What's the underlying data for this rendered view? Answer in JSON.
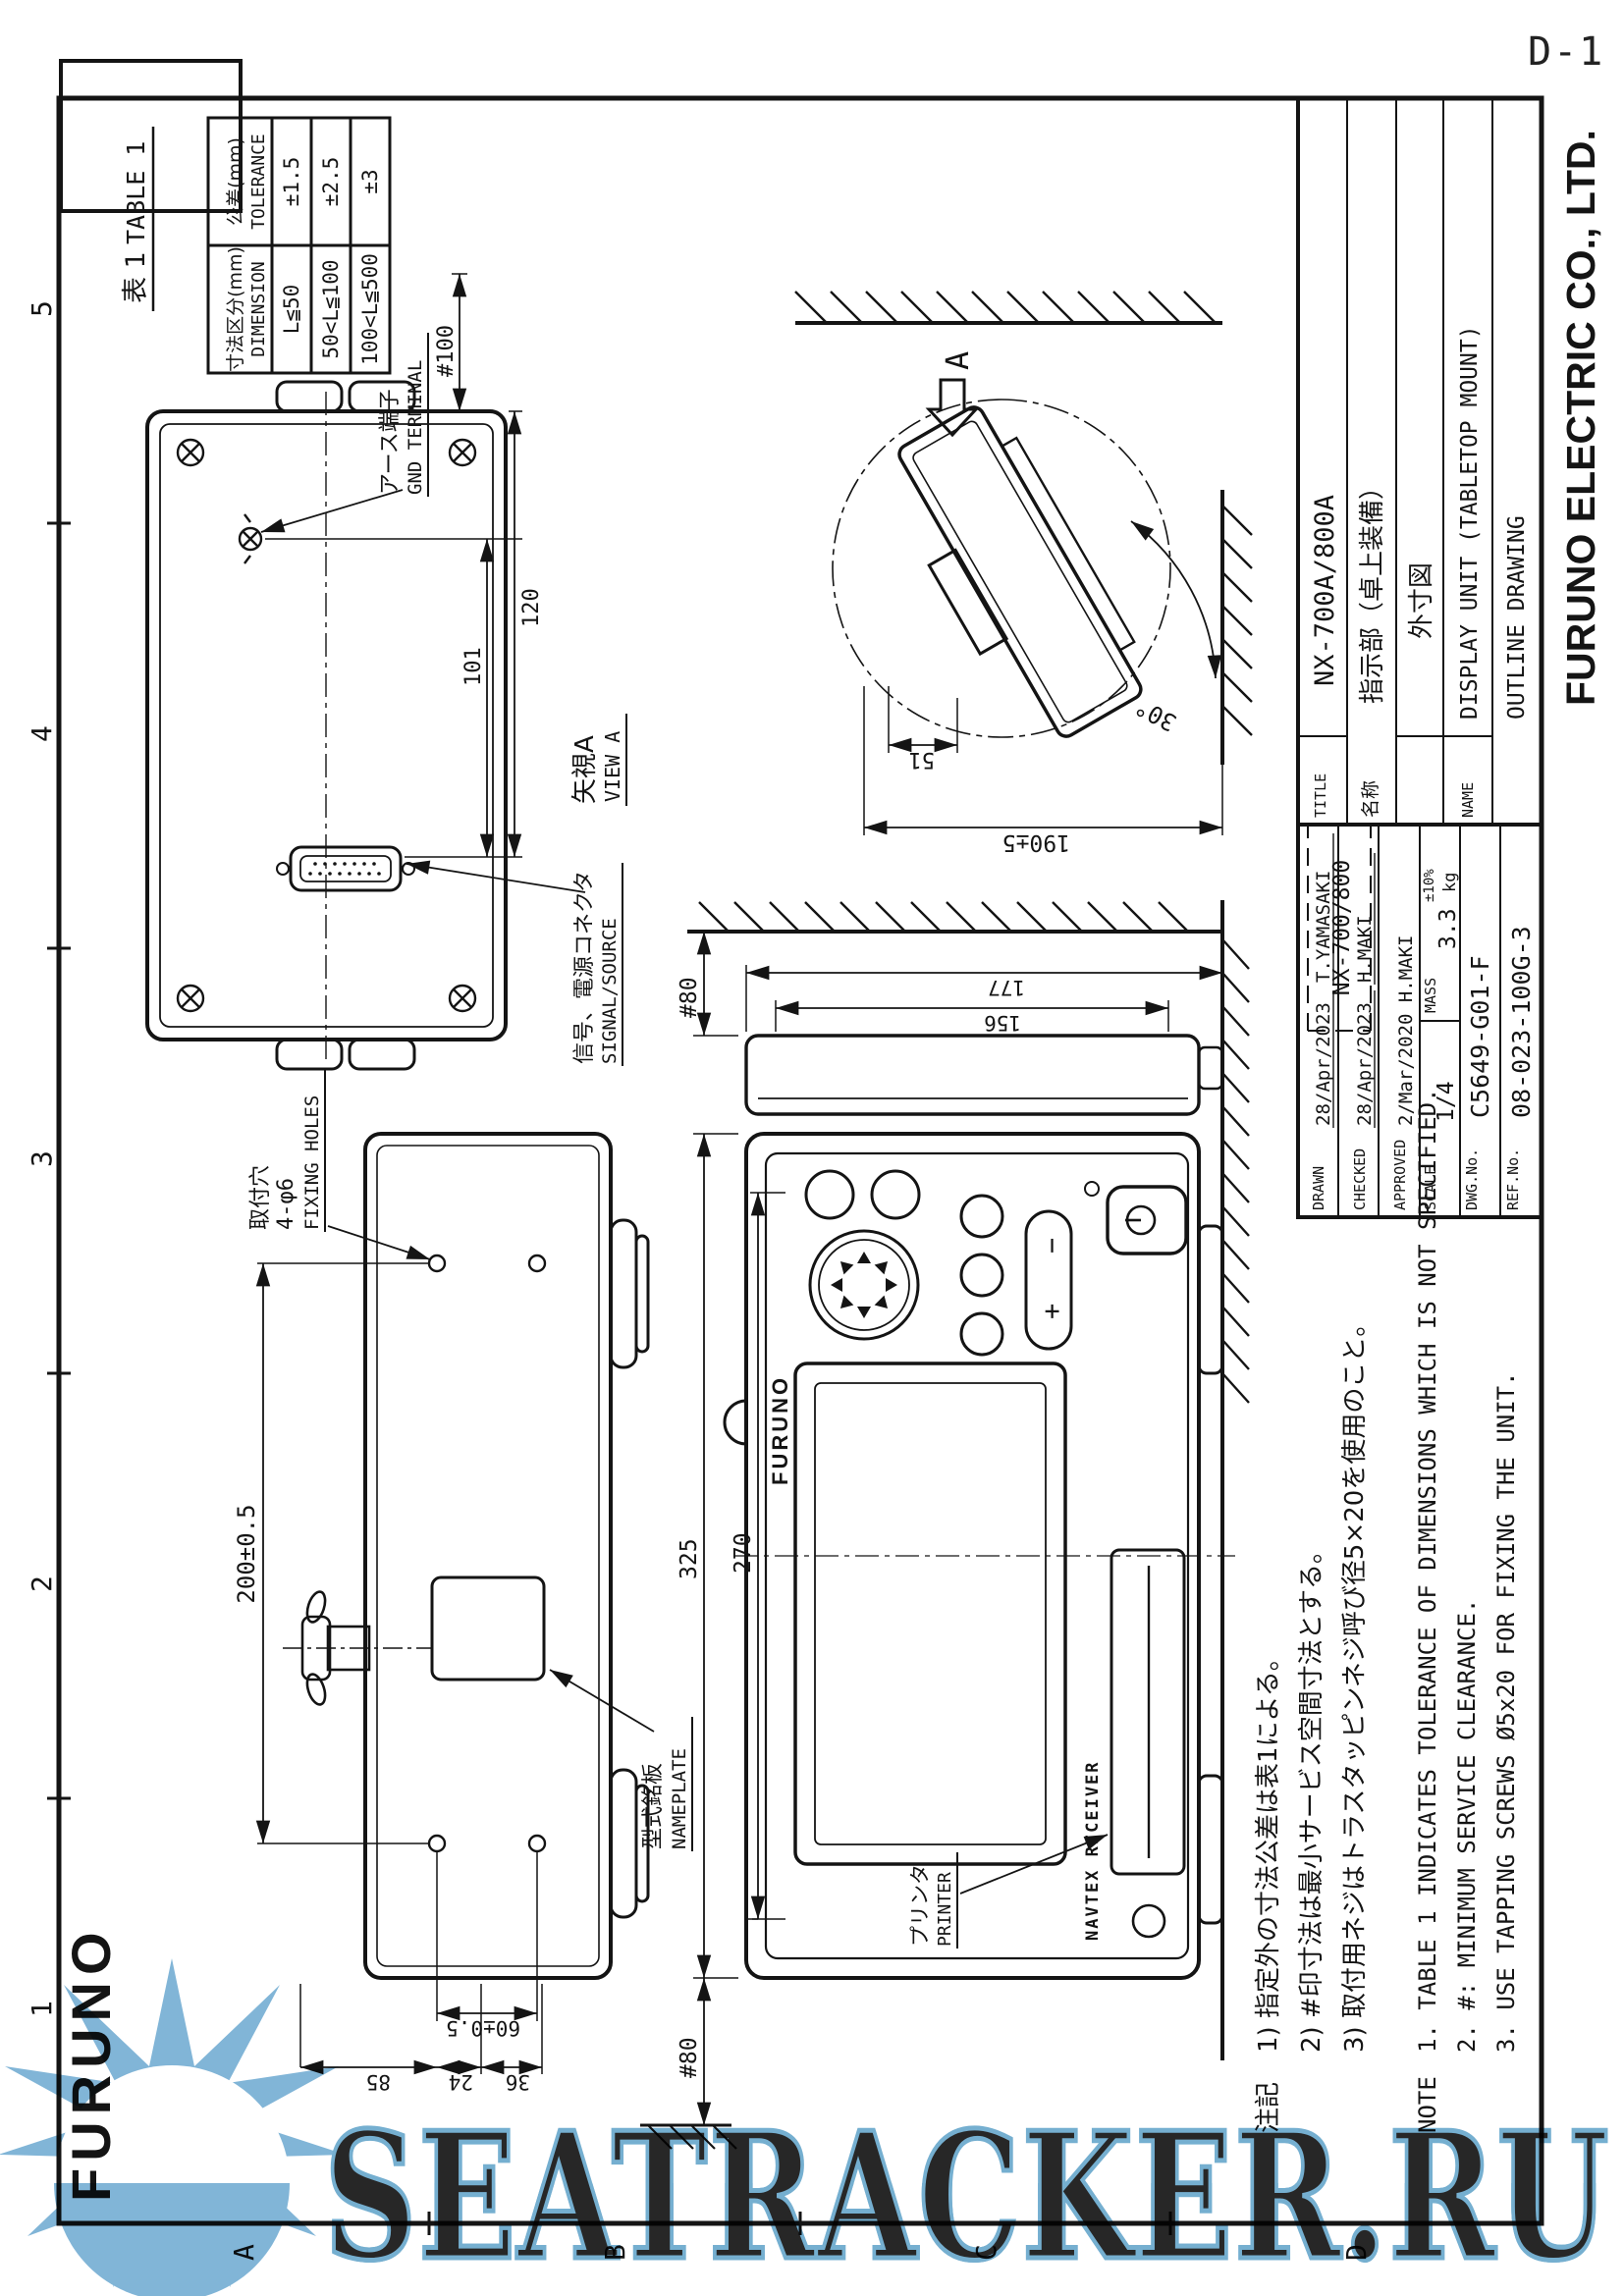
{
  "page": {
    "sheet_ref": "D-1"
  },
  "logo": "FURUNO",
  "grid": {
    "cols": [
      "1",
      "2",
      "3",
      "4",
      "5"
    ],
    "rows": [
      "A",
      "B",
      "C",
      "D"
    ]
  },
  "table1": {
    "title_jp": "表 1",
    "title_en": "TABLE 1",
    "col_dimension_jp": "寸法区分(mm)",
    "col_dimension_en": "DIMENSION",
    "col_tolerance_jp": "公差(mm)",
    "col_tolerance_en": "TOLERANCE",
    "rows": [
      {
        "dimension": "L≦50",
        "tolerance": "±1.5"
      },
      {
        "dimension": "50<L≦100",
        "tolerance": "±2.5"
      },
      {
        "dimension": "100<L≦500",
        "tolerance": "±3"
      }
    ]
  },
  "view_a": {
    "caption_jp": "矢視A",
    "caption_en": "VIEW A",
    "gnd_jp": "アース端子",
    "gnd_en": "GND TERMINAL",
    "signal_jp": "信号、電源コネクタ",
    "signal_en": "SIGNAL/SOURCE",
    "dims": {
      "d101": "101",
      "d120": "120",
      "d100": "#100"
    }
  },
  "side_view": {
    "arrow_label": "A",
    "angle": "30°",
    "height": "190±5",
    "hook": "51"
  },
  "top_view": {
    "fixing_jp": "取付穴",
    "fixing_spec": "4-φ6",
    "fixing_en": "FIXING HOLES",
    "nameplate_jp": "型式銘板",
    "nameplate_en": "NAMEPLATE",
    "dims": {
      "span": "200±0.5",
      "pitch": "60±0.5",
      "d85": "85",
      "d24": "24",
      "d36": "36"
    }
  },
  "front_view": {
    "brand": "FURUNO",
    "product": "NAVTEX RECEIVER",
    "printer_jp": "プリンタ",
    "printer_en": "PRINTER",
    "key_plus": "+",
    "key_minus": "−",
    "dims": {
      "width": "325",
      "inner": "270",
      "clear_left": "#80",
      "clear_right": "#80",
      "body": "156",
      "overall": "177"
    }
  },
  "notes": {
    "jp_label": "注記",
    "jp": [
      "1) 指定外の寸法公差は表1による。",
      "2) #印寸法は最小サービス空間寸法とする。",
      "3) 取付用ネジはトラスタッピンネジ呼び径5×20を使用のこと。"
    ],
    "en_label": "NOTE",
    "en": [
      "1. TABLE 1 INDICATES TOLERANCE OF DIMENSIONS WHICH IS NOT SPECIFIED.",
      "2. #: MINIMUM SERVICE CLEARANCE.",
      "3. USE TAPPING SCREWS Ø5x20 FOR FIXING THE UNIT."
    ]
  },
  "title_block": {
    "drawn_label": "DRAWN",
    "drawn_date": "28/Apr/2023",
    "drawn_name": "T.YAMASAKI",
    "checked_label": "CHECKED",
    "checked_date": "28/Apr/2023",
    "checked_name": "H.MAKI",
    "approved_label": "APPROVED",
    "approved_value": "2/Mar/2020 H.MAKI",
    "scale_label": "SCALE",
    "scale_value": "1/4",
    "mass_label": "MASS",
    "mass_tol": "±10%",
    "mass_value": "3.3",
    "mass_unit": "kg",
    "dwg_label": "DWG.No.",
    "dwg_value": "C5649-G01-F",
    "ref_label": "REF.No.",
    "ref_value": "08-023-100G-3",
    "model": "NX-700/800",
    "title_label": "TITLE",
    "title_value": "NX-700A/800A",
    "name_jp_label": "名称",
    "name_jp_value": "指示部（卓上装備）",
    "name_jp_value2": "外寸図",
    "name_label": "NAME",
    "name_value": "DISPLAY UNIT (TABLETOP MOUNT)",
    "name_value2": "OUTLINE DRAWING",
    "company": "FURUNO ELECTRIC CO., LTD."
  },
  "watermark": {
    "text": "SEATRACKER.RU",
    "color": "#76afd4"
  }
}
